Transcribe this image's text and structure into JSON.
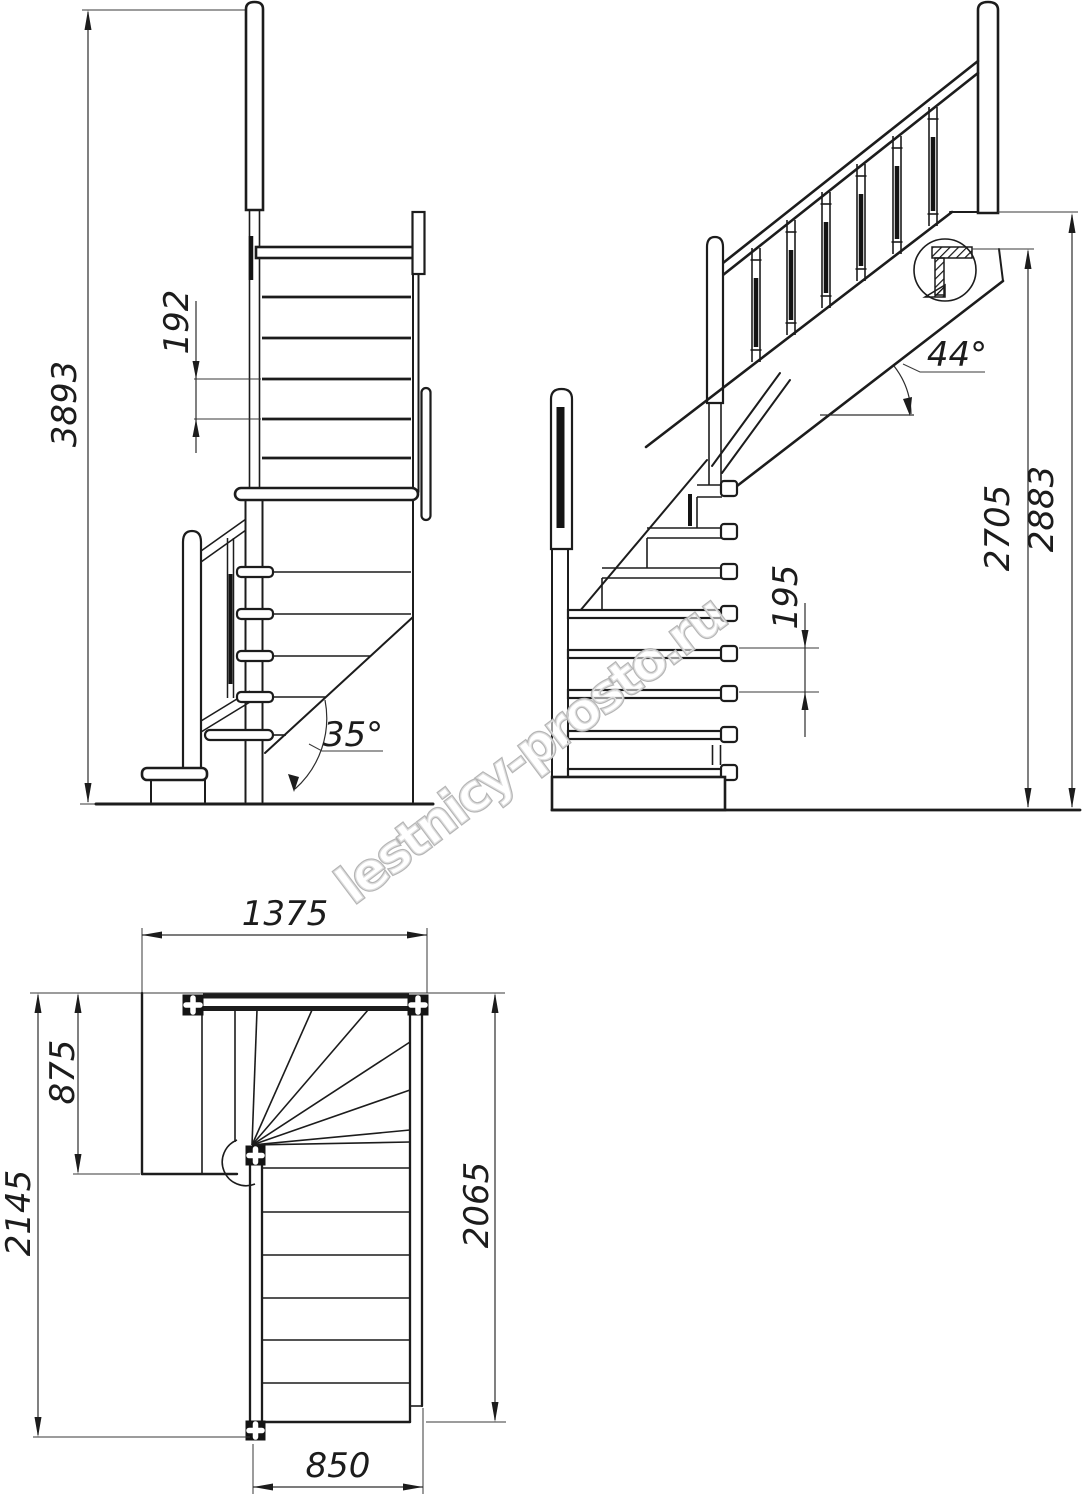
{
  "watermark": {
    "text": "lestnicy-prosto.ru",
    "color": "#b5b5b5"
  },
  "views": {
    "front": {
      "label_total_height": "3893",
      "label_step_rise": "192",
      "label_angle": "35°"
    },
    "side": {
      "label_angle": "44°",
      "label_height_to_landing": "2705",
      "label_height_to_floor": "2883",
      "label_step_rise": "195"
    },
    "plan": {
      "label_top_width": "1375",
      "label_landing_depth": "875",
      "label_total_depth": "2145",
      "label_flight_length": "2065",
      "label_flight_width": "850"
    }
  }
}
